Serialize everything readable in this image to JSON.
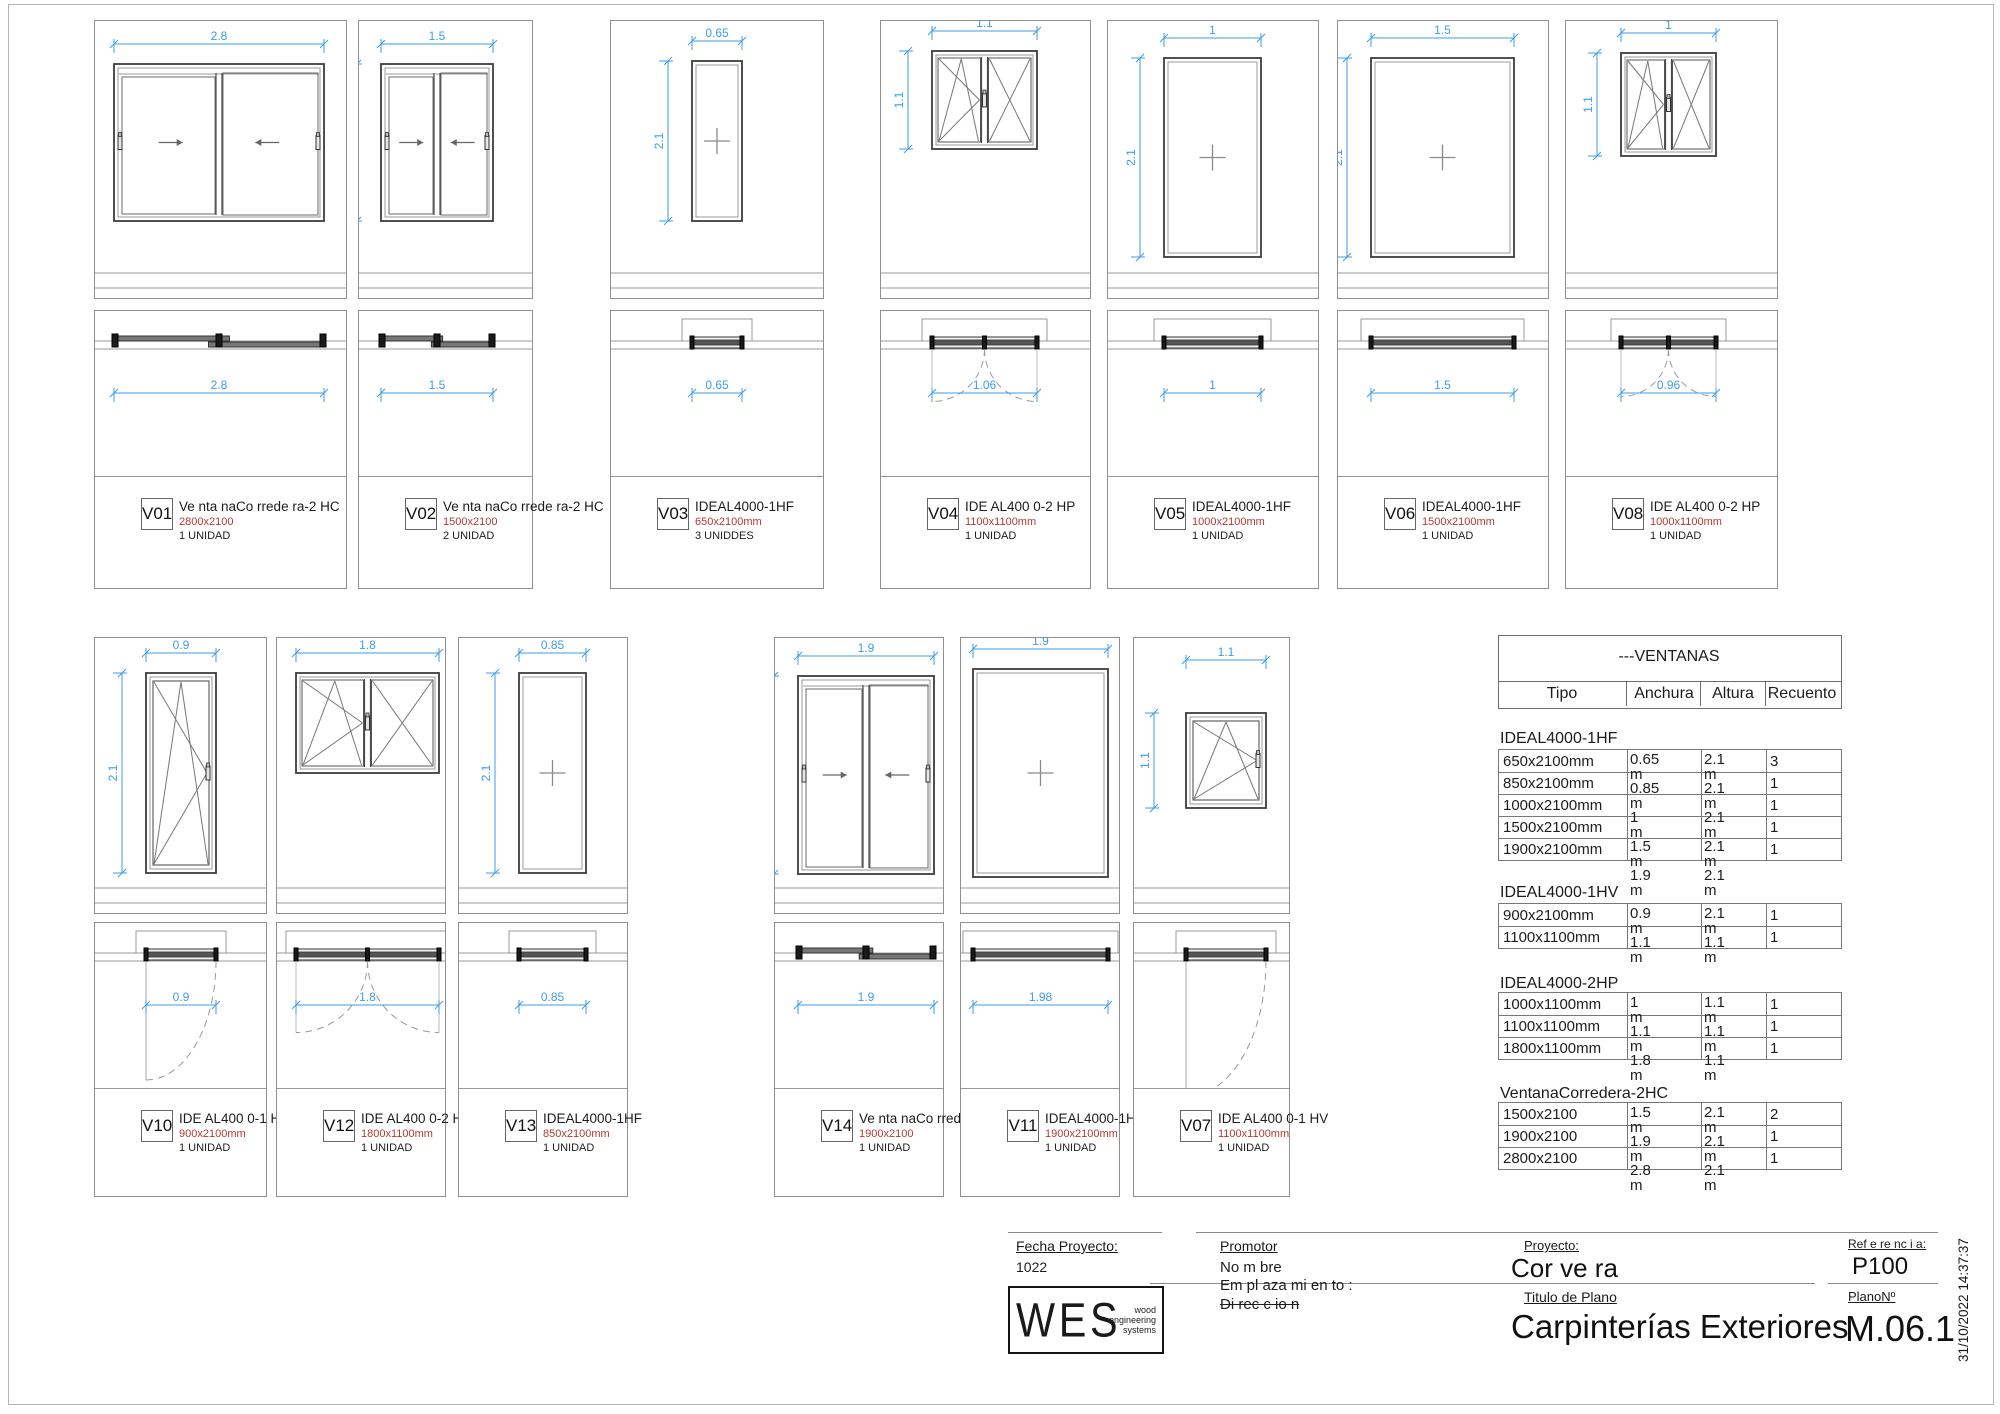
{
  "colors": {
    "dimension_blue": "#3d9de9",
    "size_red": "#b23a31",
    "drawing_gray": "#8f8f8f"
  },
  "panels": [
    {
      "tag": "V01",
      "product": "Ve nta naCo rrede ra-2 HC",
      "size": "2800x2100",
      "units": "1 UNIDAD",
      "window_type": "sliding-2-leaf",
      "dim_width": "2.8",
      "dim_height": "2.1",
      "dim_plan": "2.8"
    },
    {
      "tag": "V02",
      "product": "Ve nta naCo rrede ra-2 HC",
      "size": "1500x2100",
      "units": "2 UNIDAD",
      "window_type": "sliding-2-leaf",
      "dim_width": "1.5",
      "dim_height": "2.1",
      "dim_plan": "1.5"
    },
    {
      "tag": "V03",
      "product": "IDEAL4000-1HF",
      "size": "650x2100mm",
      "units": "3 UNIDDES",
      "window_type": "fixed",
      "dim_width": "0.65",
      "dim_height": "2.1",
      "dim_plan": "0.65"
    },
    {
      "tag": "V04",
      "product": "IDE AL400 0-2 HP",
      "size": "1100x1100mm",
      "units": "1 UNIDAD",
      "window_type": "tilt-turn-2-leaf",
      "dim_width": "1.1",
      "dim_height": "1.1",
      "dim_plan": "1.06"
    },
    {
      "tag": "V05",
      "product": "IDEAL4000-1HF",
      "size": "1000x2100mm",
      "units": "1 UNIDAD",
      "window_type": "fixed",
      "dim_width": "1",
      "dim_height": "2.1",
      "dim_plan": "1"
    },
    {
      "tag": "V06",
      "product": "IDEAL4000-1HF",
      "size": "1500x2100mm",
      "units": "1 UNIDAD",
      "window_type": "fixed",
      "dim_width": "1.5",
      "dim_height": "2.1",
      "dim_plan": "1.5"
    },
    {
      "tag": "V08",
      "product": "IDE AL400 0-2 HP",
      "size": "1000x1100mm",
      "units": "1 UNIDAD",
      "window_type": "tilt-turn-2-leaf",
      "dim_width": "1",
      "dim_height": "1.1",
      "dim_plan": "0.96"
    },
    {
      "tag": "V10",
      "product": "IDE AL400 0-1 HV",
      "size": "900x2100mm",
      "units": "1 UNIDAD",
      "window_type": "tilt-turn",
      "dim_width": "0.9",
      "dim_height": "2.1",
      "dim_plan": "0.9"
    },
    {
      "tag": "V12",
      "product": "IDE AL400 0-2 HP",
      "size": "1800x1100mm",
      "units": "1 UNIDAD",
      "window_type": "tilt-turn-2-leaf",
      "dim_width": "1.8",
      "dim_height": "1.1",
      "dim_plan": "1.8"
    },
    {
      "tag": "V13",
      "product": "IDEAL4000-1HF",
      "size": "850x2100mm",
      "units": "1 UNIDAD",
      "window_type": "fixed",
      "dim_width": "0.85",
      "dim_height": "2.1",
      "dim_plan": "0.85"
    },
    {
      "tag": "V14",
      "product": "Ve nta naCo rrede ra-2 HC",
      "size": "1900x2100",
      "units": "1 UNIDAD",
      "window_type": "sliding-2-leaf",
      "dim_width": "1.9",
      "dim_height": "2.1",
      "dim_plan": "1.9"
    },
    {
      "tag": "V11",
      "product": "IDEAL4000-1HF",
      "size": "1900x2100mm",
      "units": "1 UNIDAD",
      "window_type": "fixed",
      "dim_width": "1.9",
      "dim_height": "2.1",
      "dim_plan": "1.98"
    },
    {
      "tag": "V07",
      "product": "IDE AL400 0-1 HV",
      "size": "1100x1100mm",
      "units": "1 UNIDAD",
      "window_type": "tilt-turn",
      "dim_width": "1.1",
      "dim_height": "1.1",
      "dim_plan": ""
    }
  ],
  "table": {
    "title": "---VENTANAS",
    "columns": [
      "Tipo",
      "Anchura",
      "Altura",
      "Recuento"
    ],
    "unit_label": "m",
    "groups": [
      {
        "name": "IDEAL4000-1HF",
        "rows": [
          {
            "tipo": "650x2100mm",
            "anchura": "0.65",
            "altura": "2.1",
            "recuento": "3"
          },
          {
            "tipo": "850x2100mm",
            "anchura": "0.85",
            "altura": "2.1",
            "recuento": "1"
          },
          {
            "tipo": "1000x2100mm",
            "anchura": "1",
            "altura": "2.1",
            "recuento": "1"
          },
          {
            "tipo": "1500x2100mm",
            "anchura": "1.5",
            "altura": "2.1",
            "recuento": "1"
          },
          {
            "tipo": "1900x2100mm",
            "anchura": "1.9",
            "altura": "2.1",
            "recuento": "1"
          }
        ]
      },
      {
        "name": "IDEAL4000-1HV",
        "rows": [
          {
            "tipo": "900x2100mm",
            "anchura": "0.9",
            "altura": "2.1",
            "recuento": "1"
          },
          {
            "tipo": "1100x1100mm",
            "anchura": "1.1",
            "altura": "1.1",
            "recuento": "1"
          }
        ]
      },
      {
        "name": "IDEAL4000-2HP",
        "rows": [
          {
            "tipo": "1000x1100mm",
            "anchura": "1",
            "altura": "1.1",
            "recuento": "1"
          },
          {
            "tipo": "1100x1100mm",
            "anchura": "1.1",
            "altura": "1.1",
            "recuento": "1"
          },
          {
            "tipo": "1800x1100mm",
            "anchura": "1.8",
            "altura": "1.1",
            "recuento": "1"
          }
        ]
      },
      {
        "name": "VentanaCorredera-2HC",
        "rows": [
          {
            "tipo": "1500x2100",
            "anchura": "1.5",
            "altura": "2.1",
            "recuento": "2"
          },
          {
            "tipo": "1900x2100",
            "anchura": "1.9",
            "altura": "2.1",
            "recuento": "1"
          },
          {
            "tipo": "2800x2100",
            "anchura": "2.8",
            "altura": "2.1",
            "recuento": "1"
          }
        ]
      }
    ]
  },
  "title_block": {
    "fecha_label": "Fecha Proyecto:",
    "fecha_value": "1022",
    "logo": {
      "name": "WES",
      "tagline_1": "wood",
      "tagline_2": "engineering",
      "tagline_3": "systems"
    },
    "promotor_label": "Promotor",
    "promotor_value": "No m bre",
    "emplazamiento": "Em pl aza mi en to :",
    "direccion": "Di rec c io n",
    "proyecto_label": "Proyecto:",
    "proyecto_value": "Cor ve ra",
    "titulo_label": "Titulo de Plano",
    "titulo_value": "Carpinterías Exteriores",
    "referencia_label": "Ref e re nc i a:",
    "referencia_value": "P100",
    "plano_label": "PlanoNº",
    "plano_value": "M.06.1",
    "timestamp": "31/10/2022 14:37:37"
  }
}
